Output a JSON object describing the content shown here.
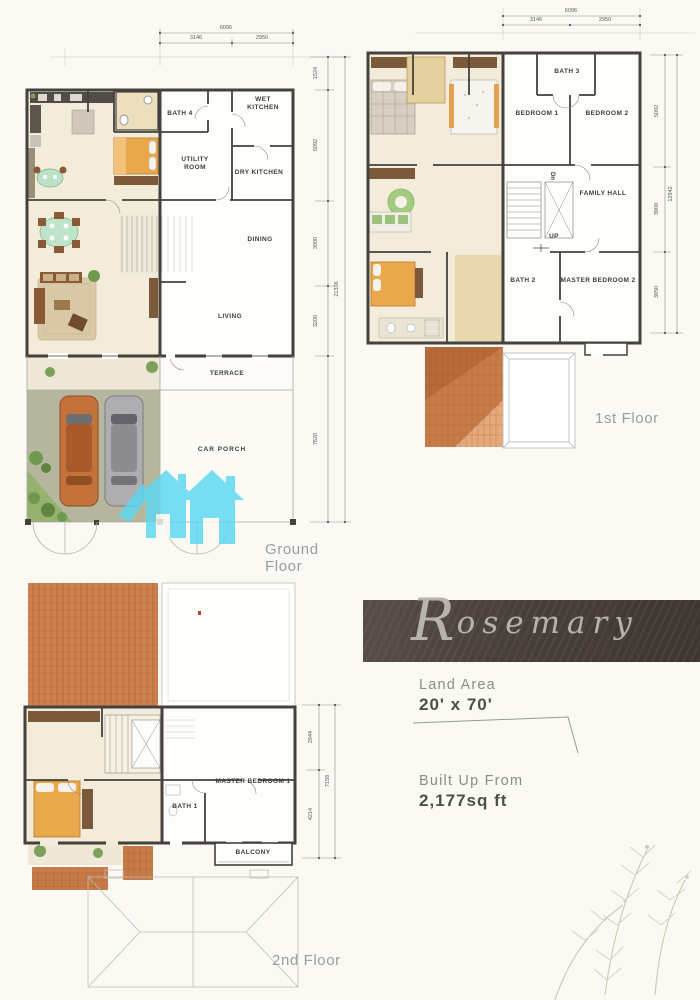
{
  "property": {
    "name": "Rosemary",
    "name_initial": "R",
    "name_rest": "osemary",
    "land_area_label": "Land Area",
    "land_area_value": "20' x 70'",
    "built_up_label": "Built Up From",
    "built_up_value": "2,177sq ft"
  },
  "floors": {
    "ground": {
      "caption": "Ground Floor",
      "rooms": {
        "bath4": "BATH 4",
        "wet_kitchen": "WET KITCHEN",
        "utility_room": "UTILITY ROOM",
        "dry_kitchen": "DRY KITCHEN",
        "dining": "DINING",
        "living": "LIVING",
        "terrace": "TERRACE",
        "car_porch": "CAR PORCH"
      },
      "dims": {
        "width_total": "6096",
        "width_left": "3146",
        "width_right": "2950",
        "h_1": "1524",
        "h_2": "5092",
        "h_3": "3900",
        "h_4": "3200",
        "h_5": "7620",
        "height_total": "21336"
      }
    },
    "first": {
      "caption": "1st Floor",
      "rooms": {
        "bath3": "BATH 3",
        "bedroom1": "BEDROOM 1",
        "bedroom2": "BEDROOM 2",
        "family_hall": "FAMILY HALL",
        "bath2": "BATH 2",
        "master_bedroom2": "MASTER BEDROOM 2"
      },
      "stairs": {
        "down": "Dn",
        "up": "UP"
      },
      "dims": {
        "width_total": "6096",
        "width_left": "3146",
        "width_right": "2950",
        "h_1": "5092",
        "h_2": "3900",
        "h_3": "3950",
        "height_total": "12942"
      }
    },
    "second": {
      "caption": "2nd Floor",
      "rooms": {
        "master_bedroom1": "MASTER BEDROOM 1",
        "bath1": "BATH 1",
        "balcony": "BALCONY"
      },
      "dims": {
        "h_1": "2944",
        "h_2": "4214",
        "height_total": "7158"
      }
    }
  },
  "colors": {
    "logo_cyan": "#5bd7f1",
    "banner_brown": "#4a403b",
    "roof_tile": "#c87c4a",
    "caption_gray": "#96a19b"
  }
}
